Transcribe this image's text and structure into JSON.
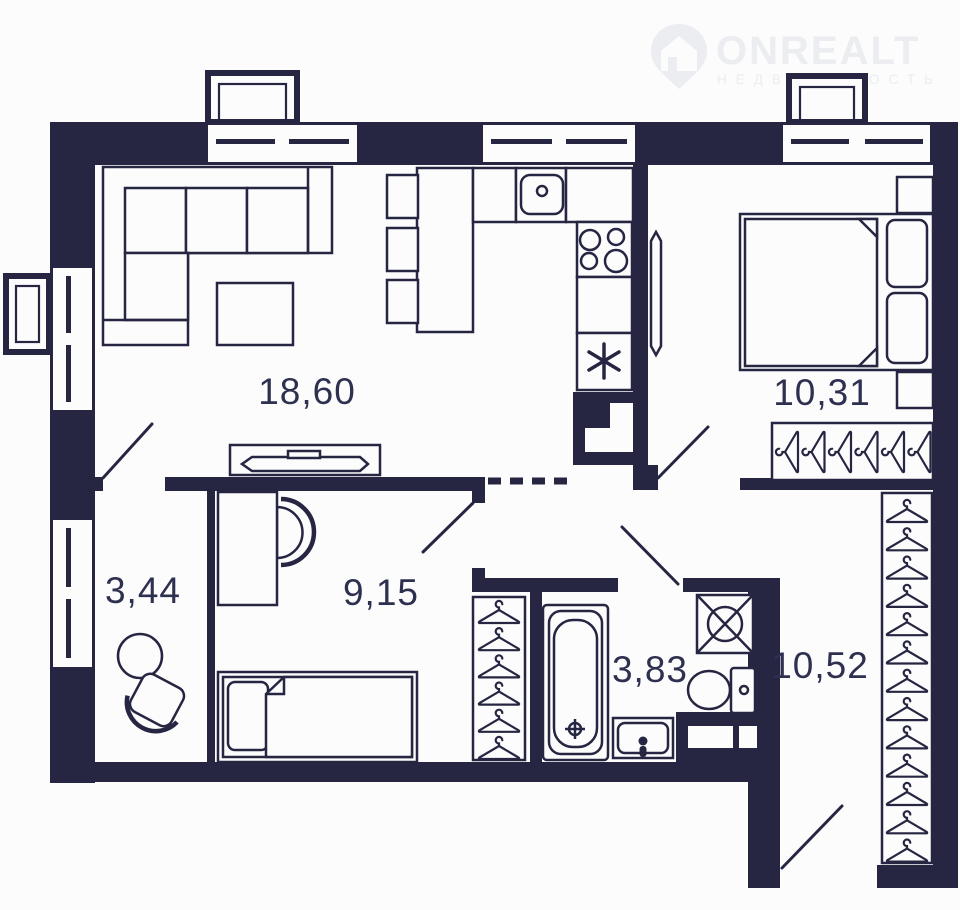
{
  "watermark": {
    "brand": "ONREALT",
    "tagline": "НЕДВИЖИМОСТЬ"
  },
  "rooms": [
    {
      "name": "living-room",
      "label": "18,60"
    },
    {
      "name": "bedroom",
      "label": "10,31"
    },
    {
      "name": "storage-room",
      "label": "3,44"
    },
    {
      "name": "second-room",
      "label": "9,15"
    },
    {
      "name": "bathroom",
      "label": "3,83"
    },
    {
      "name": "hallway",
      "label": "10,52"
    }
  ],
  "wardrobes": {
    "bedroom_hangers": 6,
    "hallway_hangers": 13,
    "room_hangers": 6
  },
  "colors": {
    "wall": "#262643",
    "background": "#fcfcfd",
    "label": "#2e3050",
    "watermark": "#ebedf1"
  }
}
